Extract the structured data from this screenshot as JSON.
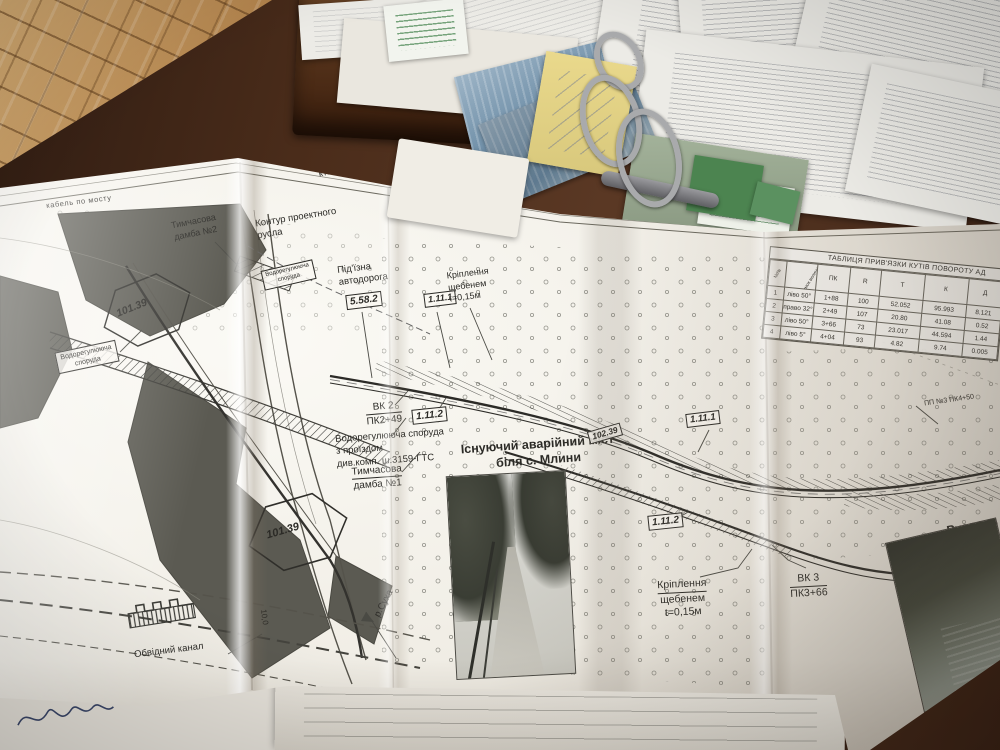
{
  "scene": {
    "desk_color": "#4a2c1a",
    "floor_color": "#c59a62",
    "paper_color": "#f2efe8",
    "accent_green": "#47804a",
    "sticky_yellow": "#e5d98f",
    "blueprint_ink": "#2b2a26"
  },
  "drawing": {
    "edge_label": "кабель по мосту",
    "header": {
      "line1": "з водних ресурсів України",
      "line2": "ктно-вишукувальний інститут",
      "line3": "\"водгосп\""
    },
    "labels": {
      "temp_dam2_1": "Тимчасова",
      "temp_dam2_2": "дамба №2",
      "contour_1": "Контур проектного",
      "contour_2": "русла",
      "water_struct_1": "Водорегулююча",
      "water_struct_2": "споруда",
      "access_road_1": "Під'їзна",
      "access_road_2": "автодорога",
      "sign_5582": "5.58.2",
      "sign_1111": "1.11.1",
      "sign_1112": "1.11.2",
      "gravel_1": "Кріплення",
      "gravel_2": "щебенем",
      "gravel_3": "t=0,15м",
      "vk2": "ВК 2",
      "pk2": "ПК2+49",
      "water_pass_1": "Водорегулююча споруда",
      "water_pass_2": "з проїздом",
      "water_pass_3": "див.комп. ш.3159-ГТС",
      "temp_dam1_1": "Тимчасова",
      "temp_dam1_2": "дамба №1",
      "bridge_caption_1": "Існуючий аварійний міст",
      "bridge_caption_2": "біля с. Млини",
      "hex_mark_1": "101.39",
      "hex_mark_2": "101.39",
      "hex_mark_3": "102.39",
      "vk3": "ВК 3",
      "pk3": "ПК3+66",
      "riverbed": "Русло р. Суха",
      "river": "р.Суха",
      "bypass_canal": "Обвідний канал",
      "pp3": "ПП №3 ПК4+50",
      "dim_10": "10,0"
    },
    "table": {
      "title": "ТАБЛИЦЯ ПРИВ'ЯЗКИ КУТІВ ПОВОРОТУ АД",
      "col_num": "№№",
      "col_dir": "напрямок величина кута",
      "col_pk": "ПК",
      "col_r": "R",
      "col_t": "Т",
      "col_k": "К",
      "col_d": "Д",
      "rows": [
        {
          "num": "1",
          "dir": "ліво 50°",
          "pk": "1+88",
          "r": "100",
          "t": "52.052",
          "k": "95.993",
          "d": "8.121"
        },
        {
          "num": "2",
          "dir": "право 32°",
          "pk": "2+49",
          "r": "107",
          "t": "20.80",
          "k": "41.08",
          "d": "0.52"
        },
        {
          "num": "3",
          "dir": "ліво 50°",
          "pk": "3+66",
          "r": "73",
          "t": "23.017",
          "k": "44.594",
          "d": "1.44"
        },
        {
          "num": "4",
          "dir": "ліво 5°",
          "pk": "4+04",
          "r": "93",
          "t": "4.82",
          "k": "9.74",
          "d": "0.005"
        }
      ]
    }
  }
}
